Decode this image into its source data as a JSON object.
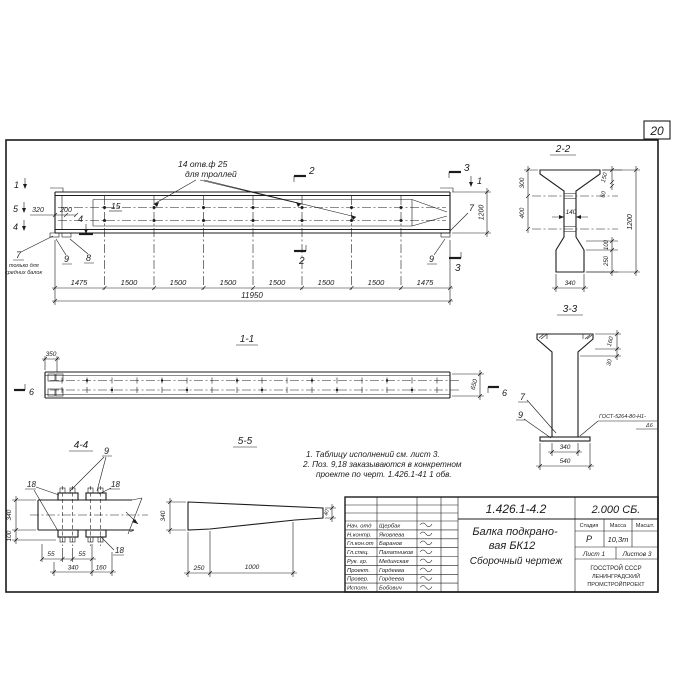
{
  "page": {
    "number": "20"
  },
  "main_view": {
    "marks": {
      "m1l": "1",
      "m5": "5",
      "m4l": "4",
      "m4i": "4",
      "m2t": "2",
      "m2b": "2",
      "m3t": "3",
      "m3b": "3",
      "m1r": "1"
    },
    "callout": {
      "line1": "14 отв.ф 25",
      "line2": "для троллей"
    },
    "pos15": "15",
    "dim320": "320",
    "dim200": "200",
    "pos7": "7",
    "pos7note1": "только для",
    "pos7note2": "средних балок",
    "pos8": "8",
    "pos9l": "9",
    "pos9r": "9",
    "pos7r": "7",
    "dim1200": "1200",
    "dims": [
      "1475",
      "1500",
      "1500",
      "1500",
      "1500",
      "1500",
      "1500",
      "1475"
    ],
    "total": "11950"
  },
  "section22": {
    "title": "2-2",
    "d300": "300",
    "d400": "400",
    "d140": "140",
    "d150": "150",
    "d50": "50",
    "d1200": "1200",
    "d100": "100",
    "d250": "250",
    "d340": "340"
  },
  "section33": {
    "title": "3-3",
    "d160": "160",
    "d30": "30",
    "d340": "340",
    "d540": "540",
    "pos7": "7",
    "pos9": "9",
    "weld1": "ГОСТ-5264-80-Н1-",
    "weld2": "Δ6"
  },
  "view11": {
    "title": "1-1",
    "d350": "350",
    "d650": "650",
    "m6l": "6",
    "m6r": "6"
  },
  "view44": {
    "title": "4-4",
    "pos9": "9",
    "pos18a": "18",
    "pos18b": "18",
    "pos18c": "18",
    "d340v": "340",
    "d100": "100",
    "d55a": "55",
    "d55b": "55",
    "d340": "340",
    "d160": "160"
  },
  "view55": {
    "title": "5-5",
    "d340": "340",
    "d250": "250",
    "d1000": "1000",
    "d40": "40"
  },
  "notes": {
    "line1": "1. Таблицу исполнений см. лист 3.",
    "line2": "2. Поз. 9,18 заказываются в конкретном",
    "line3": "проекте по черт. 1.426.1-41 1 обв."
  },
  "title_block": {
    "doc_number": "1.426.1-4.2",
    "doc_code": "2.000 СБ.",
    "product1": "Балка подкрано-",
    "product2": "вая БК12",
    "doc_type": "Сборочный чертеж",
    "col_stage": "Стадия",
    "col_mass": "Масса",
    "col_scale": "Масшт.",
    "val_stage": "Р",
    "val_mass": "10,3т",
    "sheet": "Лист 1",
    "sheets": "Листов 3",
    "org1": "ГОССТРОЙ СССР",
    "org2": "ЛЕНИНГРАДСКИЙ",
    "org3": "ПРОМСТРОЙПРОЕКТ",
    "rows": [
      {
        "role": "Нач. отд",
        "name": "Щербак"
      },
      {
        "role": "Н.контр.",
        "name": "Яковлева"
      },
      {
        "role": "Гл.кон.от",
        "name": "Баранов"
      },
      {
        "role": "Гл.спец.",
        "name": "Палатников"
      },
      {
        "role": "Рук. гр.",
        "name": "Мединская"
      },
      {
        "role": "Проект.",
        "name": "Гордеева"
      },
      {
        "role": "Провер.",
        "name": "Гордеева"
      },
      {
        "role": "Исполн.",
        "name": "Бобович"
      }
    ]
  }
}
